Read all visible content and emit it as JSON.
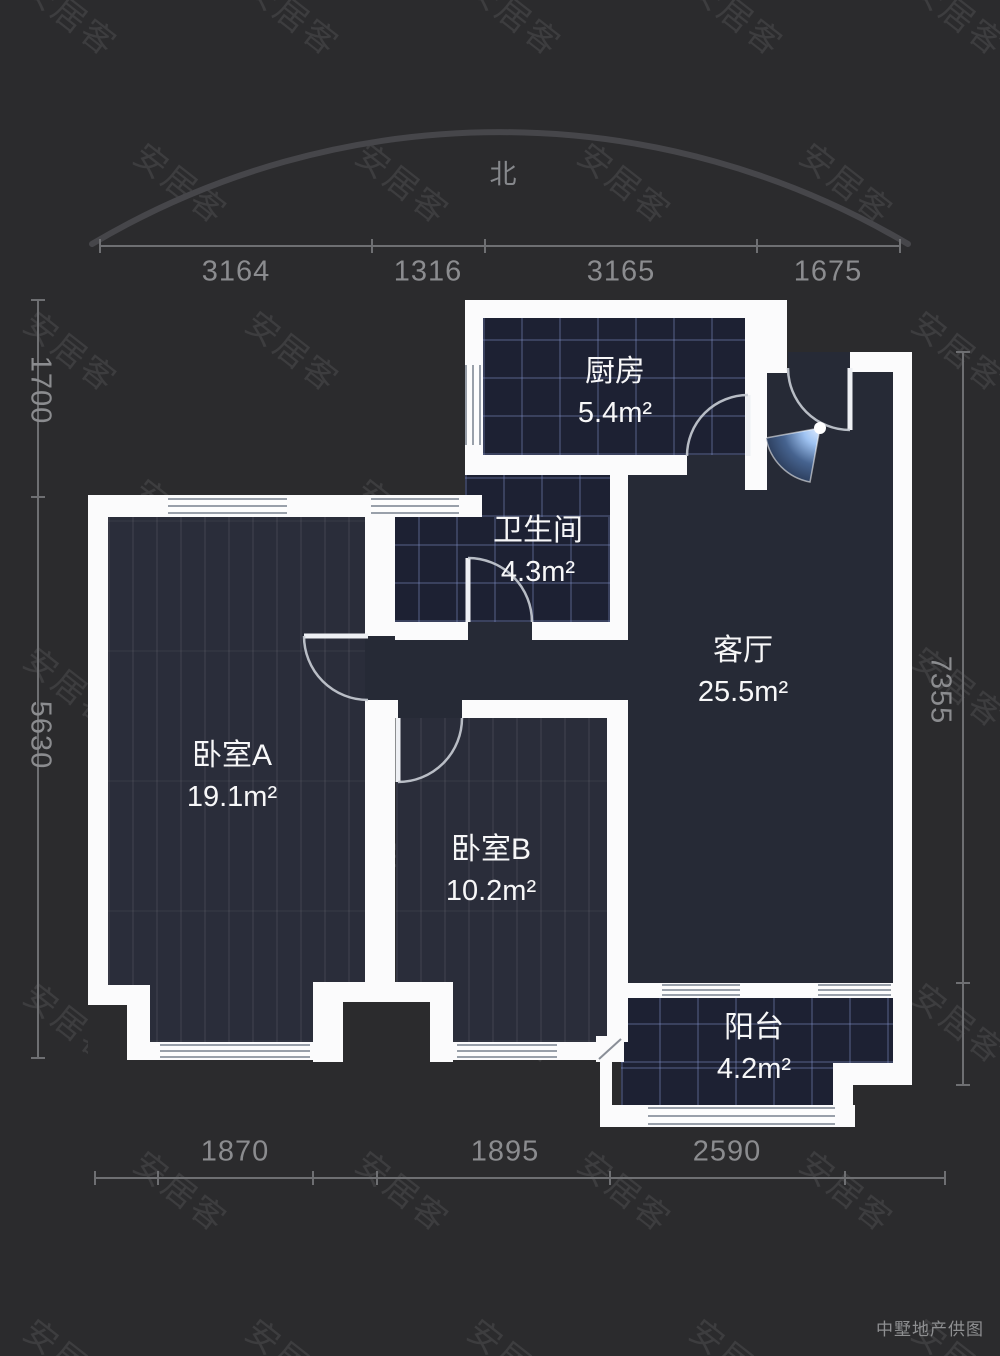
{
  "page": {
    "credit": "中墅地产供图"
  },
  "north": {
    "label": "北"
  },
  "watermark": {
    "text": "安居客"
  },
  "rooms": {
    "kitchen": {
      "name": "厨房",
      "area": "5.4m²"
    },
    "bathroom": {
      "name": "卫生间",
      "area": "4.3m²"
    },
    "living": {
      "name": "客厅",
      "area": "25.5m²"
    },
    "bedroomA": {
      "name": "卧室A",
      "area": "19.1m²"
    },
    "bedroomB": {
      "name": "卧室B",
      "area": "10.2m²"
    },
    "balcony": {
      "name": "阳台",
      "area": "4.2m²"
    }
  },
  "dimensions": {
    "top": [
      "3164",
      "1316",
      "3165",
      "1675"
    ],
    "bottom": [
      "1870",
      "1895",
      "2590"
    ],
    "left": [
      "1700",
      "5630"
    ],
    "right": [
      "7355"
    ]
  },
  "colors": {
    "wall": "#fbfbfc",
    "tile_floor": "#1d2133",
    "wood_floor": "#2a2d3a",
    "corridor_floor": "#262a36",
    "entry_accent": "#9fc3f2",
    "dim_text": "#8b8c8f"
  }
}
